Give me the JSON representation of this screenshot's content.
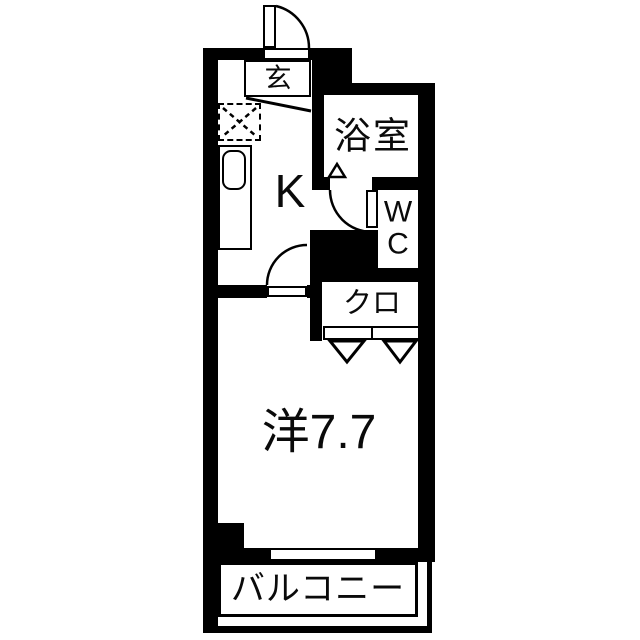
{
  "floorplan": {
    "type": "apartment-1K-floorplan",
    "rooms": {
      "genkan": {
        "label": "玄"
      },
      "kitchen": {
        "label": "K"
      },
      "bathroom": {
        "label": "浴室"
      },
      "toilet": {
        "label": "WC"
      },
      "closet": {
        "label": "クロ"
      },
      "western_room": {
        "label": "洋7.7",
        "size_tatami": "7.7"
      },
      "balcony": {
        "label": "バルコニー"
      }
    },
    "colors": {
      "wall": "#000000",
      "floor": "#ffffff",
      "line": "#000000"
    }
  }
}
